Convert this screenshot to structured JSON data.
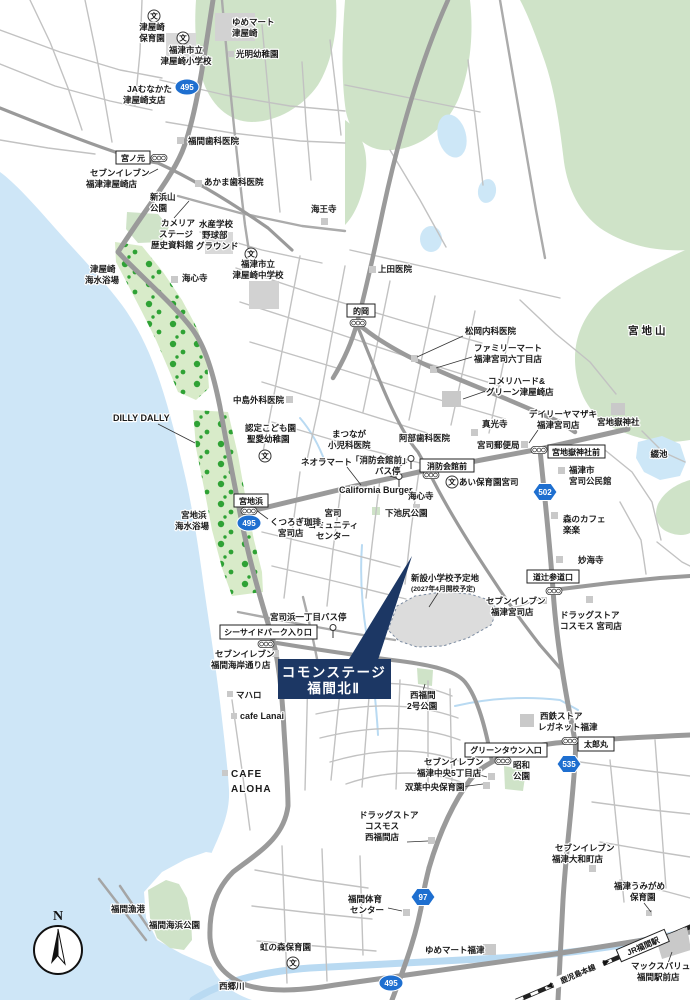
{
  "map": {
    "colors": {
      "callout_navy": "#1c3764",
      "route_badge_blue": "#1e6fd0",
      "sea_blue": "#cee6f7",
      "park_green": "#cfe3c8",
      "tree_green": "#2fa235"
    },
    "callout": {
      "line1": "コモンステージ",
      "line2": "福間北Ⅱ"
    },
    "compass": {
      "north": "N"
    },
    "icons": {
      "school_glyph": "文"
    },
    "badges": {
      "route495": "495",
      "route502": "502",
      "route535": "535",
      "route97": "97"
    },
    "intersections": {
      "miyanomoto": "宮ノ元",
      "matooka": "的岡",
      "miyajihama": "宮地浜",
      "shobokaikanmae": "消防会館前",
      "miyajidake_jinja_mae": "宮地嶽神社前",
      "michitsuji_sandoguchi": "道辻参道口",
      "seaside_park_iriguchi": "シーサイドパーク入り口",
      "greentown_iriguchi": "グリーンタウン入口",
      "taromaru": "太郎丸"
    },
    "railway": {
      "station": "JR福間駅",
      "line_name": "鹿児島本線"
    },
    "water": {
      "river": "西郷川",
      "pond": "綴池"
    },
    "terrain": {
      "mountain": "宮地山"
    },
    "site": {
      "l1": "新設小学校予定地",
      "l2": "(2027年4月開校予定)"
    },
    "pois": {
      "tsuyazaki_hoikuen": {
        "l1": "津屋崎",
        "l2": "保育園"
      },
      "yumemart_tsuyazaki": {
        "l1": "ゆめマート",
        "l2": "津屋崎"
      },
      "tsuyazaki_shogakko": {
        "l1": "福津市立",
        "l2": "津屋崎小学校"
      },
      "komyo_yochien": {
        "l1": "光明幼稚園"
      },
      "ja_munakata": {
        "l1": "JAむなかた",
        "l2": "津屋崎支店"
      },
      "fukuma_shika": {
        "l1": "福間歯科医院"
      },
      "seveneleven_tsuyazaki": {
        "l1": "セブンイレブン",
        "l2": "福津津屋崎店"
      },
      "akama_shika": {
        "l1": "あかま歯科医院"
      },
      "niihamayama_koen": {
        "l1": "新浜山",
        "l2": "公園"
      },
      "camellia_stage": {
        "l1": "カメリア",
        "l2": "ステージ",
        "l3": "歴史資料館"
      },
      "suisan_ground": {
        "l1": "水産学校",
        "l2": "野球部",
        "l3": "グラウンド"
      },
      "kaioji": {
        "l1": "海王寺"
      },
      "kaishinji_kita": {
        "l1": "海心寺"
      },
      "tsuyazaki_beach": {
        "l1": "津屋崎",
        "l2": "海水浴場"
      },
      "tsuyazaki_chugakko": {
        "l1": "福津市立",
        "l2": "津屋崎中学校"
      },
      "ueda_iin": {
        "l1": "上田医院"
      },
      "matsuoka_naika": {
        "l1": "松岡内科医院"
      },
      "familymart_miyaji": {
        "l1": "ファミリーマート",
        "l2": "福津宮司六丁目店"
      },
      "komeri": {
        "l1": "コメリハード&",
        "l2": "グリーン津屋崎店"
      },
      "daily_yamazaki": {
        "l1": "デイリーヤマザキ",
        "l2": "福津宮司店"
      },
      "miyajidake_jinja": {
        "l1": "宮地嶽神社"
      },
      "miyaji_yubinkyoku": {
        "l1": "宮司郵便局"
      },
      "shinkoji": {
        "l1": "真光寺"
      },
      "miyaji_kominkan": {
        "l1": "福津市",
        "l2": "宮司公民館"
      },
      "shobokaikanmae_busstop": {
        "l1": "「消防会館前」",
        "l2": "バス停"
      },
      "ai_hoikuen": {
        "l1": "あい保育園宮司"
      },
      "matsunaga_shonika": {
        "l1": "まつなが",
        "l2": "小児科医院"
      },
      "abe_shika": {
        "l1": "阿部歯科医院"
      },
      "neora_mart": {
        "l1": "ネオラマート"
      },
      "california_burger": {
        "l1": "California Burger"
      },
      "kaishinji_minami": {
        "l1": "海心寺"
      },
      "shimoikejiri_koen": {
        "l1": "下池尻公園"
      },
      "miyaji_community": {
        "l1": "宮司",
        "l2": "コミュニティ",
        "l3": "センター"
      },
      "kutsurogi_coffee": {
        "l1": "くつろぎ珈琲",
        "l2": "宮司店"
      },
      "miyajihama_beach": {
        "l1": "宮地浜",
        "l2": "海水浴場"
      },
      "dilly_dally": {
        "l1": "DILLY DALLY"
      },
      "nakashima_geka": {
        "l1": "中島外科医院"
      },
      "seiai_yochien": {
        "l1": "認定こども園",
        "l2": "聖愛幼稚園"
      },
      "miyajihama_1chome_busstop": {
        "l1": "宮司浜一丁目バス停"
      },
      "seveneleven_fukuma_kaigan": {
        "l1": "セブンイレブン",
        "l2": "福間海岸通り店"
      },
      "mahalo": {
        "l1": "マハロ"
      },
      "cafe_lanai": {
        "l1": "cafe Lanai"
      },
      "nishifukuma_2go_koen": {
        "l1": "西福間",
        "l2": "2号公園"
      },
      "cafe_aloha": {
        "l1": "CAFE",
        "l2": "ALOHA"
      },
      "nishitetsu_store": {
        "l1": "西鉄ストア",
        "l2": "レガネット福津"
      },
      "seveneleven_fukutsu_chuo": {
        "l1": "セブンイレブン",
        "l2": "福津中央5丁目店"
      },
      "showa_koen": {
        "l1": "昭和",
        "l2": "公園"
      },
      "futaba_chuo_hoikuen": {
        "l1": "双葉中央保育園"
      },
      "cosmos_nishifukuma": {
        "l1": "ドラッグストア",
        "l2": "コスモス",
        "l3": "西福間店"
      },
      "seveneleven_yamatomachi": {
        "l1": "セブンイレブン",
        "l2": "福津大和町店"
      },
      "umigame_hoikuen": {
        "l1": "福津うみがめ",
        "l2": "保育園"
      },
      "fukuma_taiiku_center": {
        "l1": "福間体育",
        "l2": "センター"
      },
      "yumemart_fukutsu": {
        "l1": "ゆめマート福津"
      },
      "nijinomori_hoikuen": {
        "l1": "虹の森保育園"
      },
      "fukuma_gyoko": {
        "l1": "福間漁港"
      },
      "fukuma_kaihin_koen": {
        "l1": "福間海浜公園"
      },
      "maxvalu": {
        "l1": "マックスバリュ",
        "l2": "福間駅前店"
      },
      "seveneleven_miyaji": {
        "l1": "セブンイレブン",
        "l2": "福津宮司店"
      },
      "mori_no_cafe": {
        "l1": "森のカフェ",
        "l2": "楽楽"
      },
      "myokaiji": {
        "l1": "妙海寺"
      },
      "cosmos_miyaji": {
        "l1": "ドラッグストア",
        "l2": "コスモス 宮司店"
      }
    }
  }
}
